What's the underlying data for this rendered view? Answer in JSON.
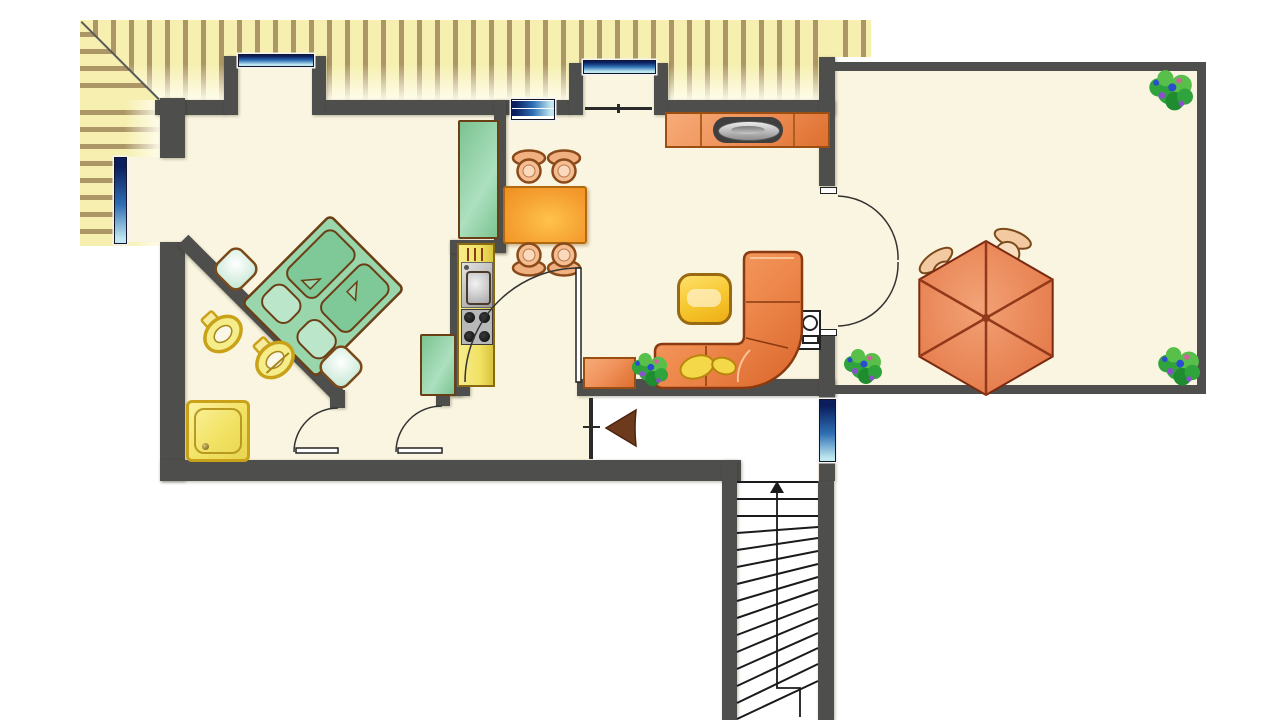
{
  "document": {
    "title": "Attic apartment floor plan with terrace",
    "kind": "architectural-floor-plan",
    "visible_text": "none"
  },
  "palette": {
    "background": "#ffffff",
    "floor": "#FAF5E0",
    "wall": "#4E4E4C",
    "roof_hatch_base": "#F6EFAF",
    "roof_hatch_stripe": "#704E2A",
    "wood_outline": "#7A4A1A",
    "furniture_orange": "#F0935C",
    "furniture_orange_dark": "#DE6F2E",
    "table_orange": "#F5A032",
    "furniture_green": "#92D2A6",
    "furniture_yellow": "#F2E264",
    "gold": "#C9A21A",
    "window_navy": "#0A1E5E",
    "window_mid": "#2E6FB4",
    "window_light": "#BFE8F0",
    "umbrella": "#EA8558",
    "umbrella_rib": "#93391B",
    "plant_green": "#2FA33C",
    "stair_line": "#1a1a1a"
  },
  "legend": {
    "walls": "thick dark gray bands",
    "roof_overhang": "yellow hatched band along top and left (sloped attic roof)",
    "windows": "blue gradient bars",
    "apartment_floor": "cream",
    "stairwell_and_entry_floor": "white"
  },
  "rooms": [
    {
      "name": "bedroom",
      "furniture": [
        "double-bed (rotated 45°)",
        "nightstand",
        "nightstand",
        "tall-green-cabinet"
      ]
    },
    {
      "name": "bathroom",
      "furniture": [
        "shower",
        "toilet",
        "bidet"
      ],
      "note": "behind diagonal wall"
    },
    {
      "name": "kitchen",
      "furniture": [
        "sink-counter",
        "4-burner-stove",
        "base-cabinet",
        "green-wardrobe"
      ]
    },
    {
      "name": "dining-area",
      "furniture": [
        "orange-dining-table",
        "stool",
        "stool",
        "stool",
        "stool"
      ],
      "windows": [
        "dormer-window",
        "double-window"
      ]
    },
    {
      "name": "living-room",
      "furniture": [
        "tv-sideboard",
        "tv",
        "corner-sofa",
        "sofa-cushion",
        "sofa-cushion",
        "coffee-table",
        "small-sideboard",
        "wall-appliance",
        "plant"
      ]
    },
    {
      "name": "inner-hallway",
      "doors": [
        "bathroom-door",
        "bedroom-door",
        "kitchen-door"
      ]
    },
    {
      "name": "entrance-hall",
      "markers": [
        "entrance-arrow",
        "entrance-door",
        "hall-window"
      ]
    },
    {
      "name": "staircase",
      "markers": [
        "up-arrow",
        "winder-steps"
      ]
    },
    {
      "name": "terrace",
      "furniture": [
        "parasol-hexagonal",
        "chair",
        "chair",
        "plant",
        "plant",
        "plant"
      ]
    }
  ],
  "counts": {
    "windows": 6,
    "dormer_alcoves": 2,
    "interior_doors": 3,
    "french_double_door": 1,
    "entrance_door": 1,
    "plants": 4
  }
}
